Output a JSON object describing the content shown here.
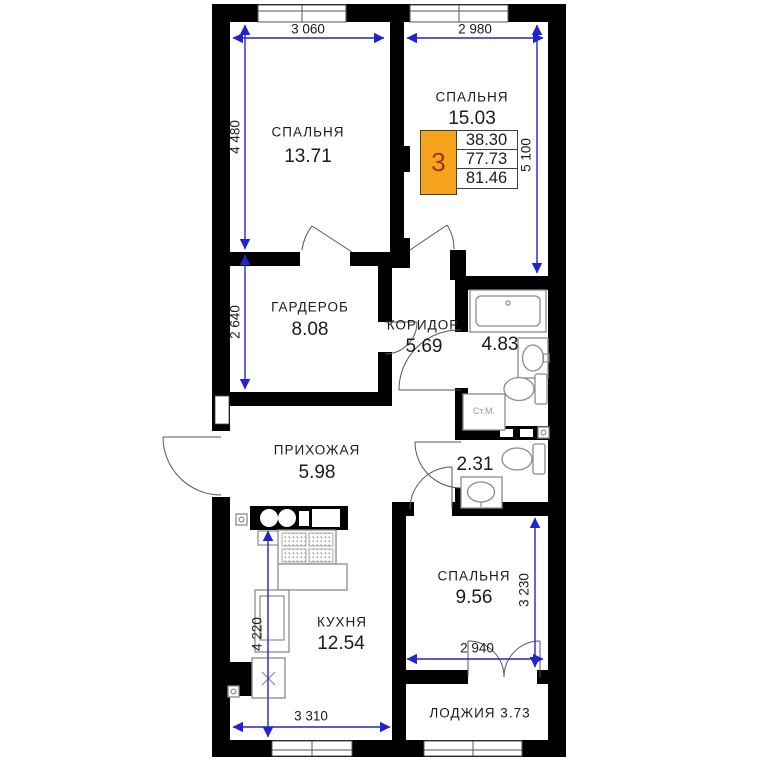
{
  "colors": {
    "wall": "#000000",
    "dimension": "#2323cd",
    "accent_orange": "#f6a41c",
    "unit_number": "#9c3500",
    "fixture": "#8c8c8c",
    "text": "#1b1b1b",
    "door": "#555555",
    "window": "#555555"
  },
  "unit_card": {
    "rooms": "3",
    "values": [
      "38.30",
      "77.73",
      "81.46"
    ]
  },
  "rooms": [
    {
      "name": "СПАЛЬНЯ",
      "area": "13.71"
    },
    {
      "name": "СПАЛЬНЯ",
      "area": "15.03"
    },
    {
      "name": "ГАРДЕРОБ",
      "area": "8.08"
    },
    {
      "name": "КОРИДОР",
      "area": "5.69"
    },
    {
      "name": "",
      "area": "4.83"
    },
    {
      "name": "ПРИХОЖАЯ",
      "area": "5.98"
    },
    {
      "name": "",
      "area": "2.31"
    },
    {
      "name": "СПАЛЬНЯ",
      "area": "9.56"
    },
    {
      "name": "КУХНЯ",
      "area": "12.54"
    },
    {
      "name": "ЛОДЖИЯ",
      "area": "3.73"
    }
  ],
  "dimensions": [
    "3 060",
    "2 980",
    "4 480",
    "5 100",
    "2 640",
    "4 220",
    "3 310",
    "3 230",
    "2 940"
  ],
  "labels": {
    "washing_machine": "Ст.М."
  }
}
